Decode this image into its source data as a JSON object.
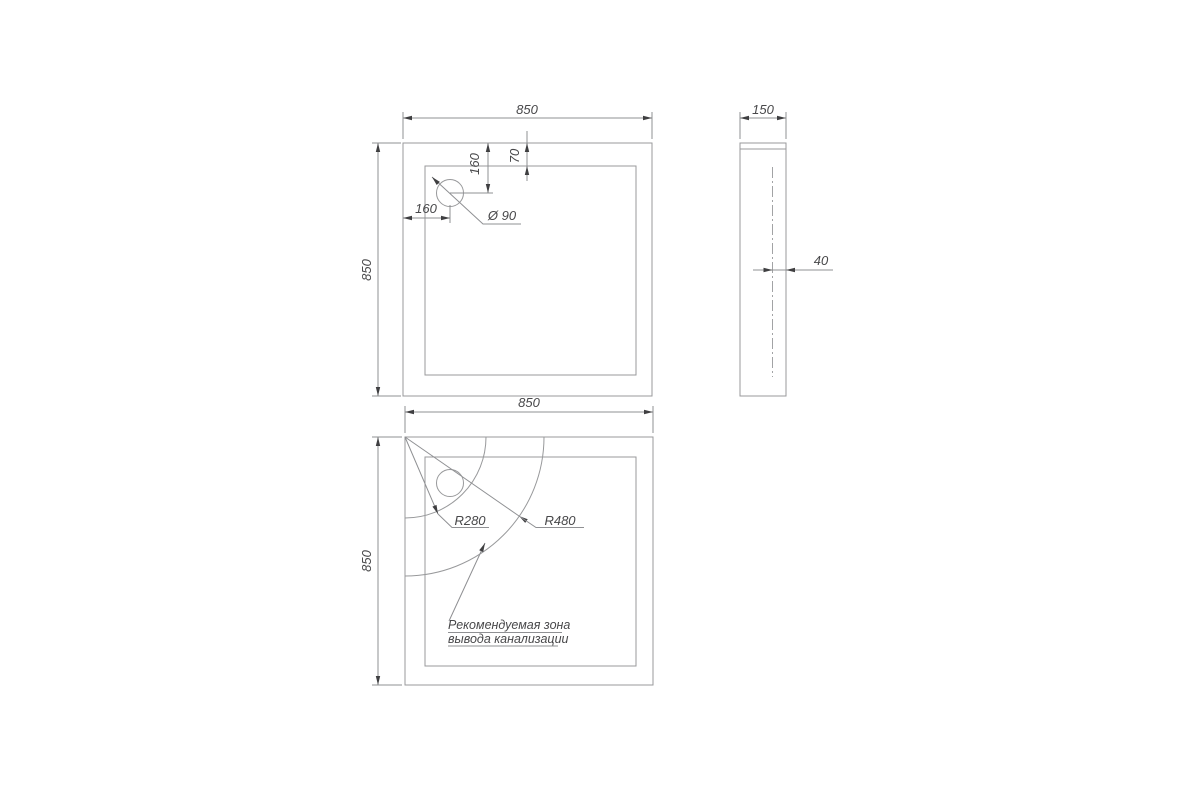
{
  "drawing_title": "Shower tray technical drawing",
  "views": {
    "plan": {
      "width": "850",
      "height": "850",
      "rim_width": "70",
      "drain_offset_top": "160",
      "drain_offset_left": "160",
      "drain_diameter": "Ø 90"
    },
    "side": {
      "width": "150",
      "drain_offset": "40"
    },
    "bottom": {
      "width": "850",
      "height": "850",
      "radius_inner": "R280",
      "radius_outer": "R480",
      "note_line1": "Рекомендуемая зона",
      "note_line2": "вывода канализации"
    }
  },
  "colors": {
    "object_line": "#98999b",
    "dimension_line": "#8f9093",
    "text": "#48484a",
    "hatch": "#b9b9bb",
    "background": "#ffffff"
  }
}
